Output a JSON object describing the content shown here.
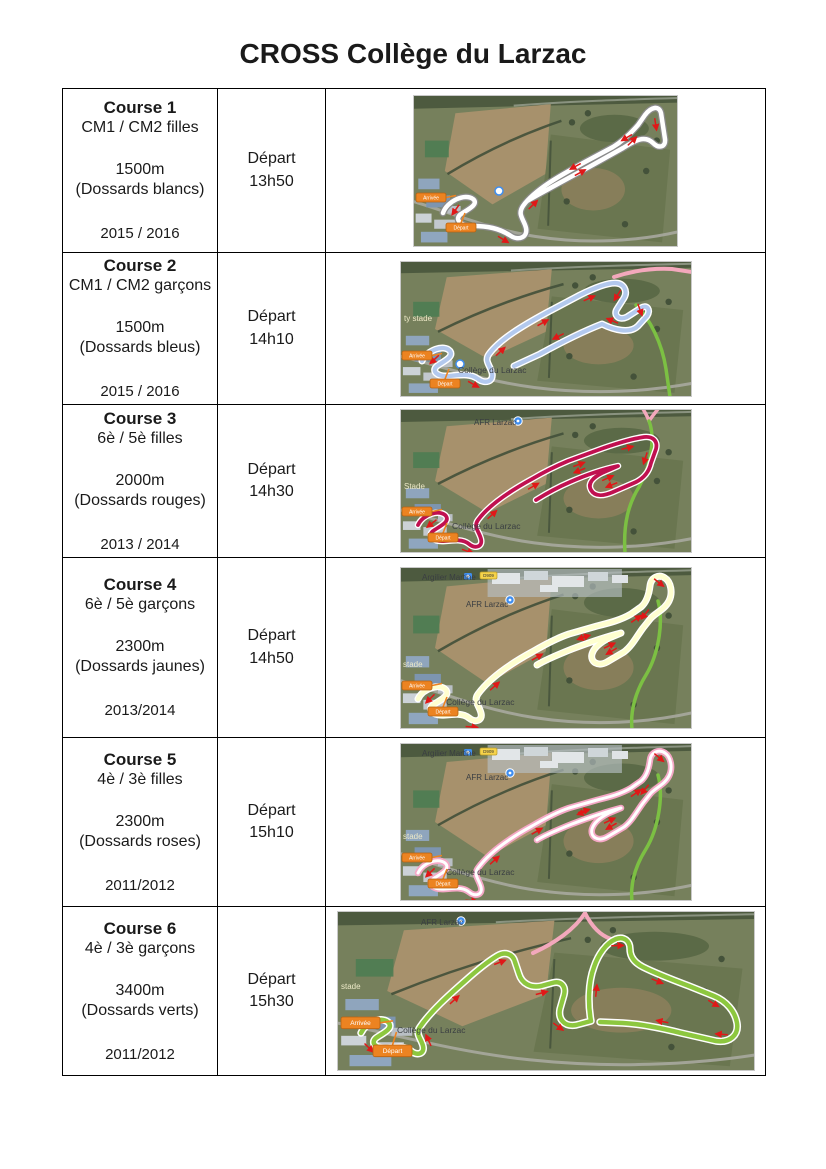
{
  "title": "CROSS Collège du Larzac",
  "table": {
    "rows": [
      {
        "course": "Course 1",
        "category": "CM1 / CM2 filles",
        "distance": "1500m",
        "bib": "(Dossards blancs)",
        "years": "2015 / 2016",
        "depart_label": "Départ",
        "depart_time": "13h50",
        "map": {
          "width": 265,
          "height": 152,
          "route_style": {
            "casing": "#8a8a8a",
            "casing_w": 7,
            "core": "#ffffff",
            "core_w": 4.5
          },
          "route_path": "M 30,118 C 34,106 52,98 60,104 C 66,109 56,114 48,119 C 41,124 47,131 60,131 C 74,131 86,133 98,141 C 106,146 115,142 113,133 C 111,124 104,120 110,111 C 122,94 150,79 172,67 L 200,52 C 210,46 218,38 225,30 L 232,20 C 238,12 246,10 248,18 L 252,44 C 253,52 246,54 240,48 C 231,39 220,47 210,53 L 176,72 C 150,86 128,98 114,106",
          "arrow_color": "#e01818",
          "arrows": 8,
          "roads": [],
          "industrial": false,
          "labels": [],
          "pins": [],
          "roundabout": {
            "x": 86,
            "y": 96
          },
          "badges": {
            "arrivee": {
              "label": "Arrivée",
              "x": 3,
              "y": 98,
              "scale": 1
            },
            "depart": {
              "label": "Départ",
              "x": 33,
              "y": 128,
              "scale": 1
            }
          }
        }
      },
      {
        "course": "Course 2",
        "category": "CM1 / CM2 garçons",
        "distance": "1500m",
        "bib": "(Dossards bleus)",
        "years": "2015 / 2016",
        "depart_label": "Départ",
        "depart_time": "14h10",
        "map": {
          "width": 292,
          "height": 136,
          "route_style": {
            "casing": "#ffffff",
            "casing_w": 7,
            "core": "#b3c9ee",
            "core_w": 4.2
          },
          "route_path": "M 22,100 C 27,89 44,83 50,90 C 54,96 44,100 37,105 C 31,110 37,116 49,115 C 60,114 70,112 78,118 C 85,123 94,121 92,112 C 90,104 84,100 89,93 C 100,78 124,64 146,52 L 180,34 C 190,29 206,22 215,22 C 224,22 228,30 224,37 L 217,48 C 213,54 219,60 227,56 L 241,47 C 247,43 251,49 247,55 L 238,65 C 230,73 214,69 202,63 C 184,70 160,82 140,93 L 114,105",
          "arrow_color": "#e01818",
          "arrows": 9,
          "roads": [
            {
              "color": "#f3a8bc",
              "w": 4,
              "d": "M 214,16 C 232,10 252,7 272,8 L 292,11"
            },
            {
              "color": "#7cc043",
              "w": 3.5,
              "d": "M 236,44 C 250,58 262,82 266,108 L 270,136"
            }
          ],
          "industrial": false,
          "labels": [
            {
              "text": "ty stade",
              "x": 4,
              "y": 60,
              "size": 8,
              "color": "#ede9c8"
            },
            {
              "text": "Collège du Larzac",
              "x": 58,
              "y": 112,
              "size": 8.5,
              "color": "#3a3e42"
            }
          ],
          "pins": [],
          "roundabout": {
            "x": 60,
            "y": 103
          },
          "badges": {
            "arrivee": {
              "label": "Arrivée",
              "x": 2,
              "y": 90,
              "scale": 1
            },
            "depart": {
              "label": "Départ",
              "x": 30,
              "y": 118,
              "scale": 1
            }
          }
        }
      },
      {
        "course": "Course 3",
        "category": "6è / 5è filles",
        "distance": "2000m",
        "bib": "(Dossards rouges)",
        "years": "2013 / 2014",
        "depart_label": "Départ",
        "depart_time": "14h30",
        "map": {
          "width": 292,
          "height": 144,
          "route_style": {
            "casing": "#ffffff",
            "casing_w": 6.5,
            "core": "#c01050",
            "core_w": 3.8
          },
          "route_path": "M 18,116 C 23,105 40,100 46,107 C 50,113 40,117 33,122 C 27,127 33,133 45,132 C 54,131 63,130 69,135 C 75,140 83,138 81,130 C 79,122 73,118 78,111 C 89,96 110,82 132,70 C 144,63 156,57 168,52 L 198,41 C 212,36 230,30 244,28 C 253,27 258,32 256,40 L 251,54 C 249,63 244,69 236,73 L 213,83 C 204,87 195,88 191,81 C 187,74 194,68 202,64 L 218,57 C 204,60 186,66 170,73 C 156,79 144,86 136,91",
          "arrow_color": "#e01818",
          "arrows": 10,
          "roads": [
            {
              "color": "#f3a8bc",
              "w": 3.5,
              "d": "M 243,0 C 246,5 248,9 249,12 M 258,0 C 254,5 251,9 249,12"
            },
            {
              "color": "#7cc043",
              "w": 3.5,
              "d": "M 249,12 C 256,30 250,58 239,78 C 229,94 223,114 225,144"
            }
          ],
          "industrial": false,
          "labels": [
            {
              "text": "AFR Larzac",
              "x": 74,
              "y": 16,
              "size": 8,
              "color": "#3a3e42"
            },
            {
              "text": "Stade",
              "x": 4,
              "y": 80,
              "size": 8,
              "color": "#ede9c8"
            },
            {
              "text": "Collège du Larzac",
              "x": 52,
              "y": 120,
              "size": 8.5,
              "color": "#3a3e42"
            }
          ],
          "pins": [
            {
              "type": "place",
              "x": 118,
              "y": 12
            }
          ],
          "roundabout": null,
          "badges": {
            "arrivee": {
              "label": "Arrivée",
              "x": 2,
              "y": 98,
              "scale": 1
            },
            "depart": {
              "label": "Départ",
              "x": 28,
              "y": 124,
              "scale": 1
            }
          }
        }
      },
      {
        "course": "Course 4",
        "category": "6è / 5è garçons",
        "distance": "2300m",
        "bib": "(Dossards jaunes)",
        "years": "2013/2014",
        "depart_label": "Départ",
        "depart_time": "14h50",
        "map": {
          "width": 292,
          "height": 162,
          "route_style": {
            "casing": "#ffffff",
            "casing_w": 7,
            "core": "#ffffd0",
            "core_w": 4.5
          },
          "route_path": "M 18,132 C 23,121 40,116 46,123 C 50,129 40,133 33,138 C 27,143 33,149 45,148 C 54,147 63,146 69,151 C 75,156 83,154 81,146 C 79,138 73,134 78,127 C 89,112 110,97 132,85 C 144,78 157,71 169,67 L 197,59 C 209,56 221,53 231,47 L 241,40 C 247,35 249,27 250,19 C 251,10 259,7 265,11 C 271,15 273,26 269,34 C 265,42 257,45 251,51 L 243,61 C 237,69 232,79 224,85 L 207,95 C 198,100 190,95 192,87 C 194,80 201,75 209,71 L 221,66 C 205,70 188,76 172,82 C 157,88 145,93 137,98",
          "arrow_color": "#e01818",
          "arrows": 11,
          "roads": [
            {
              "color": "#7cc043",
              "w": 3.5,
              "d": "M 258,34 C 264,56 258,88 246,108 C 236,124 230,144 232,162"
            }
          ],
          "industrial": true,
          "labels": [
            {
              "text": "Argilier Martine",
              "x": 22,
              "y": 13,
              "size": 8,
              "color": "#3a3e42"
            },
            {
              "text": "AFR Larzac",
              "x": 66,
              "y": 40,
              "size": 8,
              "color": "#3a3e42"
            },
            {
              "text": "stade",
              "x": 3,
              "y": 100,
              "size": 8,
              "color": "#ede9c8"
            },
            {
              "text": "Collège du Larzac",
              "x": 46,
              "y": 138,
              "size": 8.5,
              "color": "#3a3e42"
            }
          ],
          "pins": [
            {
              "type": "camera",
              "x": 64,
              "y": 6
            },
            {
              "type": "roadbadge",
              "label": "D909",
              "x": 80,
              "y": 5
            },
            {
              "type": "place",
              "x": 110,
              "y": 33
            }
          ],
          "roundabout": null,
          "badges": {
            "arrivee": {
              "label": "Arrivée",
              "x": 2,
              "y": 114,
              "scale": 1
            },
            "depart": {
              "label": "Départ",
              "x": 28,
              "y": 140,
              "scale": 1
            }
          }
        }
      },
      {
        "course": "Course 5",
        "category": "4è / 3è filles",
        "distance": "2300m",
        "bib": "(Dossards roses)",
        "years": "2011/2012",
        "depart_label": "Départ",
        "depart_time": "15h10",
        "map": {
          "width": 292,
          "height": 158,
          "route_style": {
            "casing": "#f5a8c6",
            "casing_w": 6.5,
            "core": "#ffffff",
            "core_w": 3
          },
          "route_path": "M 18,130 C 23,119 40,114 46,121 C 50,127 40,131 33,136 C 27,141 33,147 45,146 C 54,145 63,144 69,149 C 75,154 83,152 81,144 C 79,136 73,132 78,125 C 89,110 110,95 132,83 C 144,76 157,69 169,65 L 197,57 C 209,54 221,51 231,45 L 241,38 C 247,33 249,25 250,17 C 251,9 259,6 265,10 C 271,14 273,25 269,33 C 265,41 257,44 251,50 L 243,60 C 237,68 232,78 224,84 L 207,94 C 198,99 190,94 192,86 C 194,79 201,74 209,70 L 221,65 C 205,69 188,75 172,81 C 157,87 145,92 137,97",
          "arrow_color": "#e01818",
          "arrows": 11,
          "roads": [
            {
              "color": "#7cc043",
              "w": 3.5,
              "d": "M 258,32 C 264,54 258,86 246,106 C 236,122 230,140 232,158"
            }
          ],
          "industrial": true,
          "labels": [
            {
              "text": "Argilier Martine",
              "x": 22,
              "y": 13,
              "size": 8,
              "color": "#3a3e42"
            },
            {
              "text": "AFR Larzac",
              "x": 66,
              "y": 37,
              "size": 8,
              "color": "#3a3e42"
            },
            {
              "text": "stade",
              "x": 3,
              "y": 96,
              "size": 8,
              "color": "#ede9c8"
            },
            {
              "text": "Collège du Larzac",
              "x": 46,
              "y": 132,
              "size": 8.5,
              "color": "#3a3e42"
            }
          ],
          "pins": [
            {
              "type": "camera",
              "x": 64,
              "y": 6
            },
            {
              "type": "roadbadge",
              "label": "D909",
              "x": 80,
              "y": 5
            },
            {
              "type": "place",
              "x": 110,
              "y": 30
            }
          ],
          "roundabout": null,
          "badges": {
            "arrivee": {
              "label": "Arrivée",
              "x": 2,
              "y": 110,
              "scale": 1
            },
            "depart": {
              "label": "Départ",
              "x": 28,
              "y": 136,
              "scale": 1
            }
          }
        }
      },
      {
        "course": "Course 6",
        "category": "4è / 3è garçons",
        "distance": "3400m",
        "bib": "(Dossards verts)",
        "years": "2011/2012",
        "depart_label": "Départ",
        "depart_time": "15h30",
        "map": {
          "width": 418,
          "height": 160,
          "route_style": {
            "casing": "#ffffff",
            "casing_w": 7.5,
            "core": "#8dc73f",
            "core_w": 4.5
          },
          "route_path": "M 24,122 C 30,110 46,105 52,112 C 56,118 46,122 39,127 C 33,132 39,138 51,137 C 60,136 68,135 74,140 C 80,145 88,143 86,135 C 84,127 78,123 83,116 C 94,100 112,84 128,70 C 138,61 150,51 160,45 C 168,40 176,43 178,51 L 182,63 C 185,73 194,77 204,75 L 215,72 C 225,69 229,76 227,84 L 223,98 C 221,108 227,116 239,114 L 254,110 C 251,94 251,72 257,56 C 261,44 269,32 279,28 C 287,25 293,30 293,38 C 293,46 298,52 306,56 C 320,63 336,69 352,75 L 377,85 C 389,90 398,100 400,112 C 402,124 393,132 379,130 L 344,122 C 324,117 304,113 286,112 L 263,111",
          "arrow_color": "#e01818",
          "arrows": 12,
          "roads": [
            {
              "color": "#f3a8bc",
              "w": 4,
              "d": "M 196,42 C 218,32 238,18 248,2 M 248,2 C 254,14 262,24 274,28"
            }
          ],
          "industrial": false,
          "labels": [
            {
              "text": "AFR Larzac",
              "x": 84,
              "y": 14,
              "size": 8,
              "color": "#3a3e42"
            },
            {
              "text": "stade",
              "x": 4,
              "y": 78,
              "size": 8,
              "color": "#ede9c8"
            },
            {
              "text": "Collège du Larzac",
              "x": 60,
              "y": 122,
              "size": 8.5,
              "color": "#3a3e42"
            }
          ],
          "pins": [
            {
              "type": "place",
              "x": 124,
              "y": 10
            }
          ],
          "roundabout": null,
          "badges": {
            "arrivee": {
              "label": "Arrivée",
              "x": 4,
              "y": 106,
              "scale": 1.3
            },
            "depart": {
              "label": "Départ",
              "x": 36,
              "y": 134,
              "scale": 1.3
            }
          }
        }
      }
    ]
  },
  "map_colors": {
    "badge_fill": "#ec8321",
    "badge_stroke": "#b56312",
    "badge_text": "#ffffff",
    "pin_blue": "#3f8ef0",
    "road_badge_fill": "#f6d34a"
  }
}
